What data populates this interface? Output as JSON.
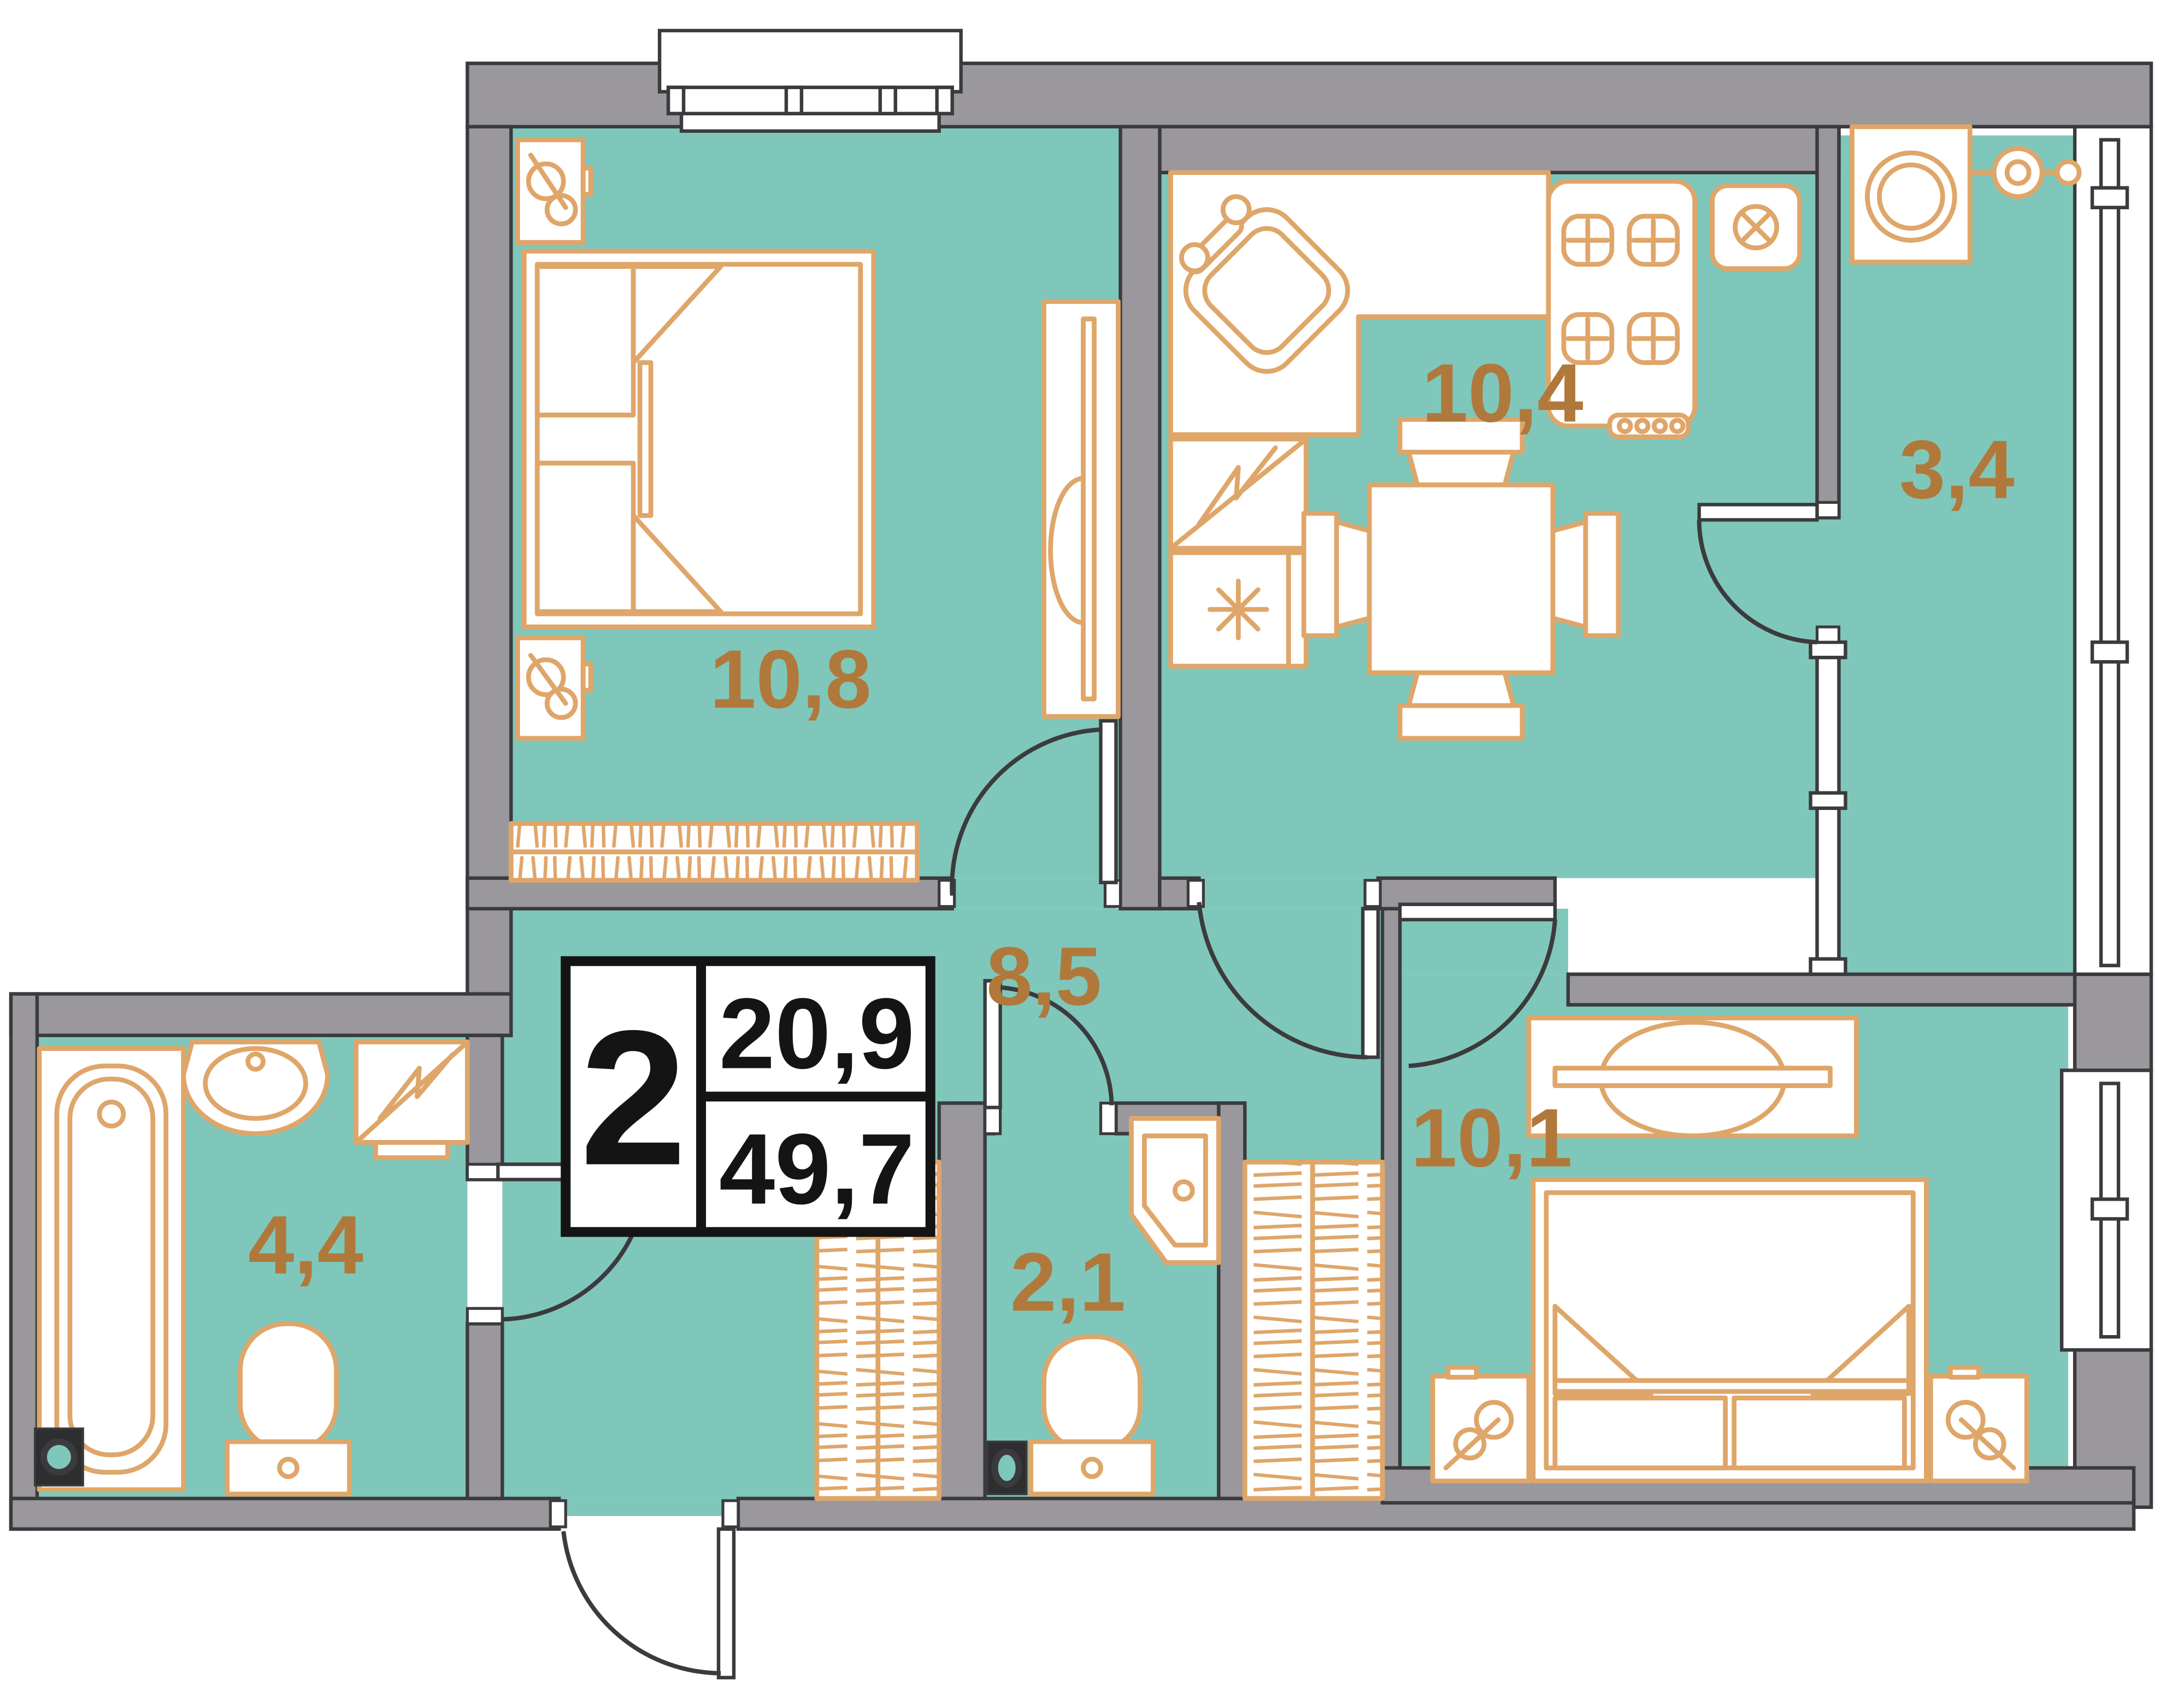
{
  "floorplan": {
    "title": "2-room apartment floor plan",
    "info_box": {
      "rooms_count": "2",
      "living_area": "20,9",
      "total_area": "49,7"
    },
    "room_labels": {
      "bedroom1": "10,8",
      "kitchen": "10,4",
      "loggia": "3,4",
      "hallway": "8,5",
      "bathroom": "4,4",
      "wc": "2,1",
      "bedroom2": "10,1"
    },
    "colors": {
      "floor": "#7fc7bb",
      "wall": "#9a979d",
      "outline": "#3b3b3d",
      "furniture": "#dfa66a",
      "label": "#b0793b",
      "info": "#141414",
      "bg": "#ffffff"
    }
  }
}
